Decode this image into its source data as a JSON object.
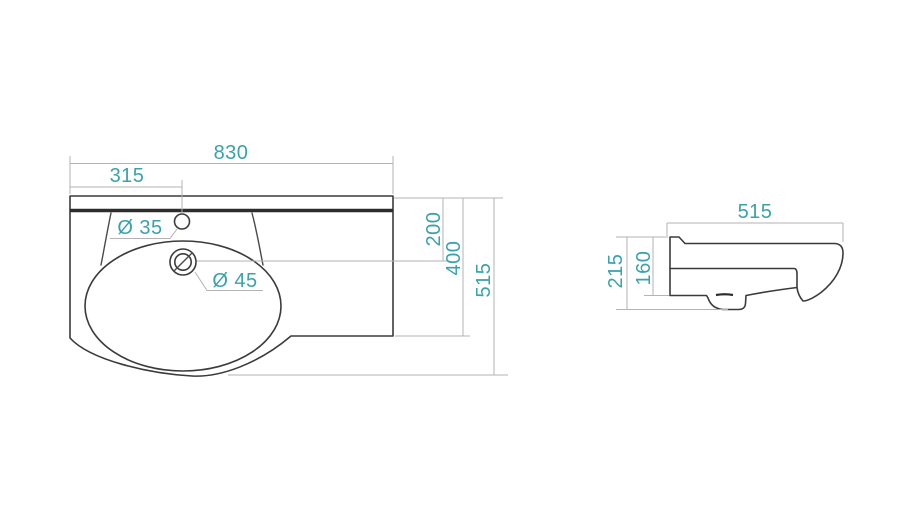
{
  "colors": {
    "dimension_text": "#3aa2aa",
    "outline": "#3b3b3b",
    "bold_edge": "#2d2d2d",
    "dimension_line": "#b3b3b3",
    "background": "#ffffff"
  },
  "front_view": {
    "dims": {
      "width": "830",
      "faucet_offset": "315",
      "faucet_hole": "Ø 35",
      "drain_hole": "Ø 45",
      "drain_depth": "200",
      "body_depth": "400",
      "total_depth": "515"
    }
  },
  "side_view": {
    "dims": {
      "depth": "515",
      "total_height": "215",
      "body_height": "160"
    }
  }
}
